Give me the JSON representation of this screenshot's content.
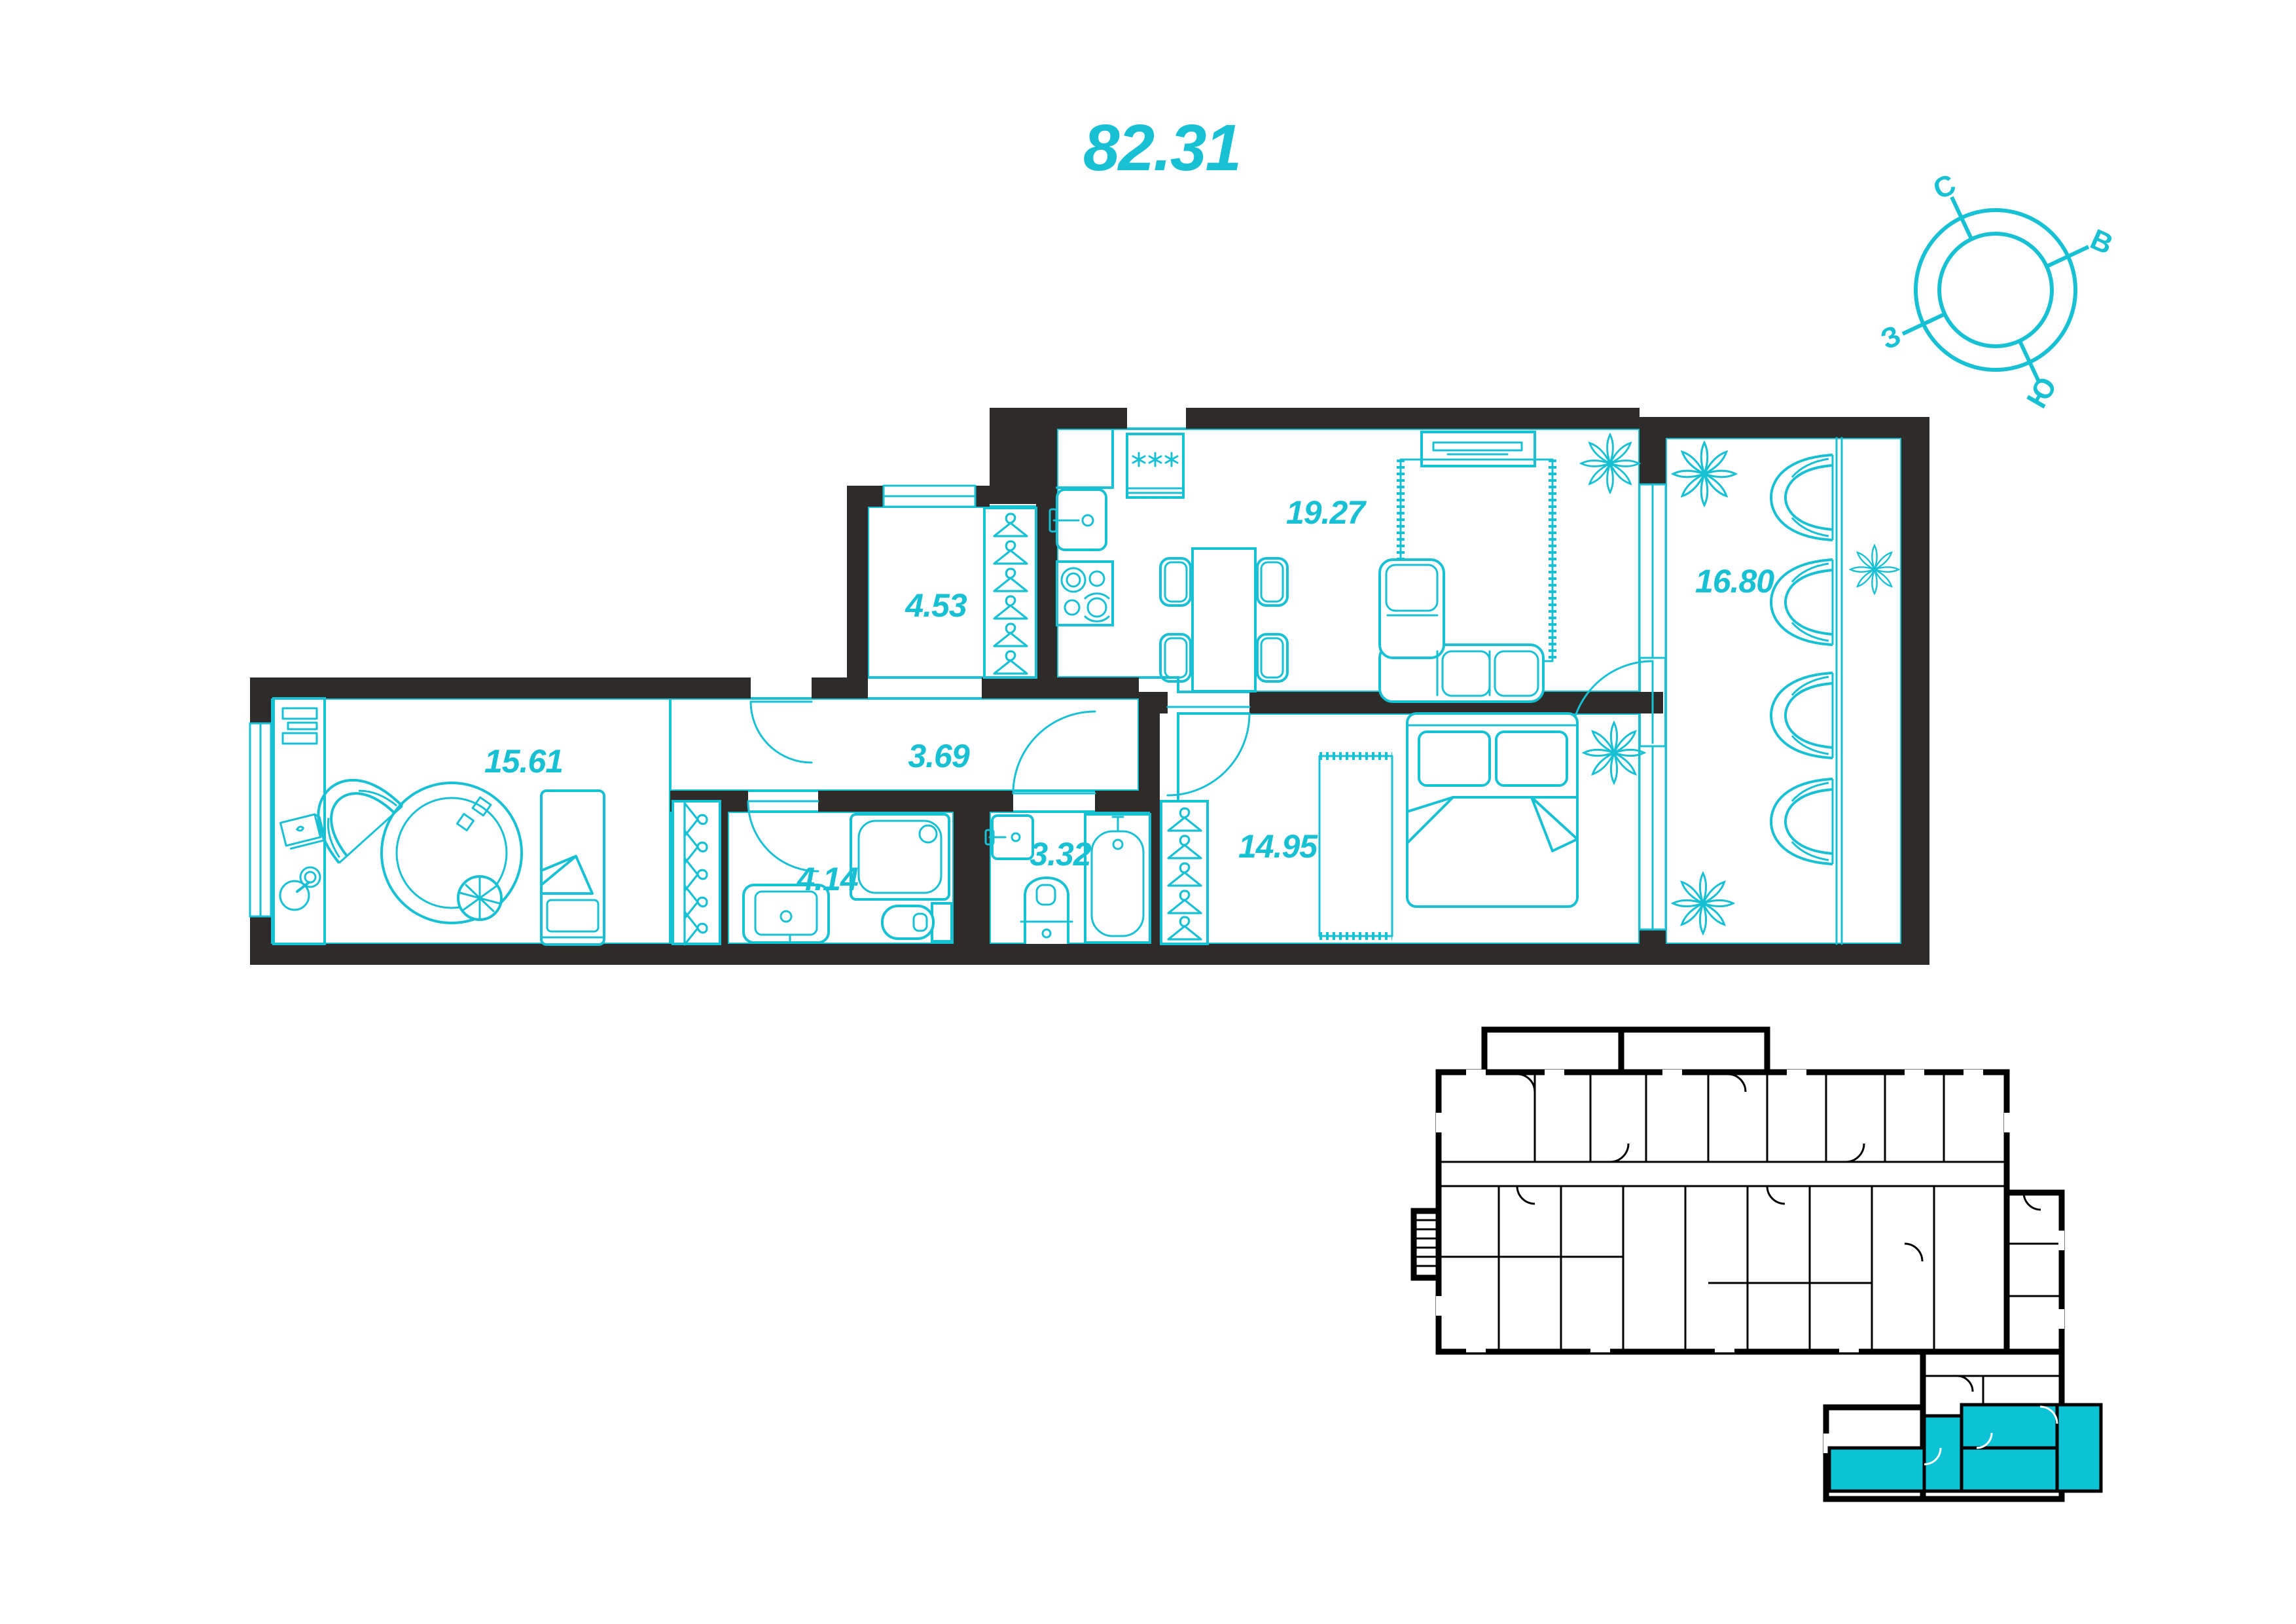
{
  "title": {
    "total_area": "82.31"
  },
  "compass": {
    "labels": {
      "north": "С",
      "east": "В",
      "south": "Ю",
      "west": "З"
    },
    "rotation_deg": 25
  },
  "plan": {
    "rooms": [
      {
        "name": "kitchen-living-room",
        "area": "19.27"
      },
      {
        "name": "walk-in-closet",
        "area": "4.53"
      },
      {
        "name": "hallway",
        "area": "3.69"
      },
      {
        "name": "room-secondary",
        "area": "15.61"
      },
      {
        "name": "bathroom",
        "area": "4.14"
      },
      {
        "name": "wc",
        "area": "3.32"
      },
      {
        "name": "bedroom",
        "area": "14.95"
      },
      {
        "name": "balcony",
        "area": "16.80"
      }
    ],
    "fixtures": [
      "fridge",
      "sink",
      "stove",
      "dining-table",
      "tv-stand",
      "sofa",
      "rug",
      "double-bed",
      "single-bed",
      "shower",
      "bathtub",
      "toilet",
      "wash-basin",
      "wardrobe-hangers",
      "lounge-chairs",
      "plants",
      "desk",
      "lamp"
    ]
  },
  "key_plan": {
    "highlight": "current-apartment"
  },
  "colors": {
    "accent": "#17c0d2",
    "walls": "#2d2c2a",
    "key_plan_lines": "#000000",
    "key_plan_highlight": "#0cc3d5",
    "background": "#ffffff"
  }
}
